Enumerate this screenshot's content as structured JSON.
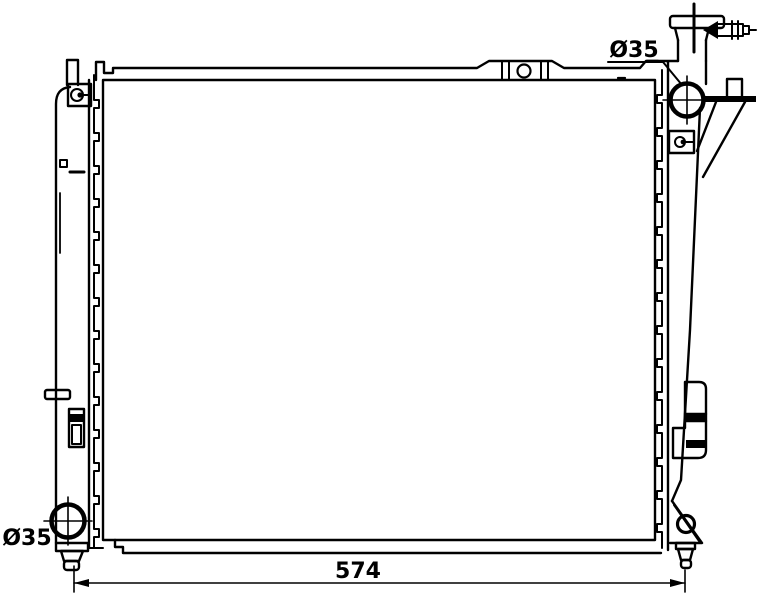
{
  "colors": {
    "line": "#000000",
    "background": "#ffffff"
  },
  "labels": {
    "inlet_diameter": "Ø35",
    "outlet_diameter": "Ø35",
    "width_dimension": "574"
  }
}
